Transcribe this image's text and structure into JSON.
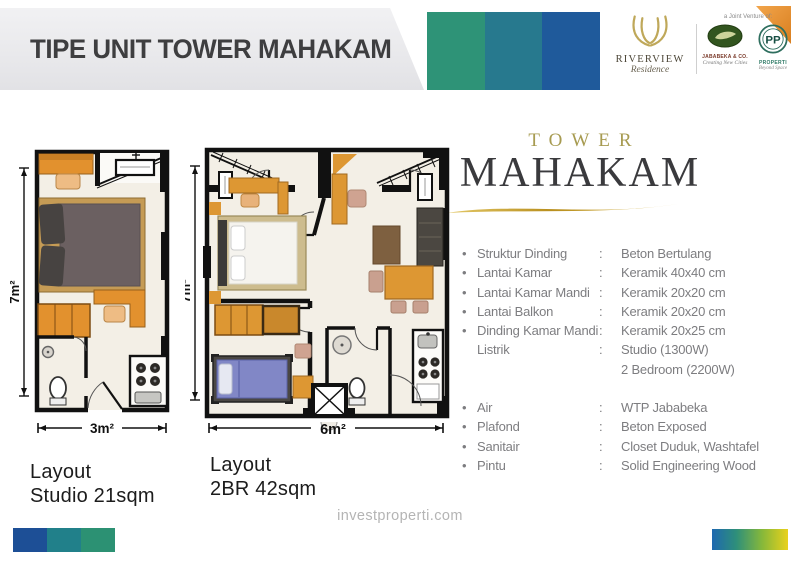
{
  "header": {
    "title": "TIPE UNIT TOWER MAHAKAM",
    "logos": {
      "riverview": {
        "name": "RIVERVIEW",
        "sub": "Residence"
      },
      "joint_venture_label": "a Joint Venture of:",
      "jababeka": {
        "name": "JABABEKA & CO.",
        "tagline": "Creating New Cities"
      },
      "pp": {
        "monogram": "PP",
        "name": "PROPERTI",
        "tagline": "Beyond Space"
      }
    }
  },
  "tower": {
    "pre": "TOWER",
    "name": "MAHAKAM"
  },
  "specs": {
    "items": [
      {
        "bullet": "•",
        "label": "Struktur Dinding",
        "colon": ":",
        "value": "Beton Bertulang"
      },
      {
        "bullet": "•",
        "label": "Lantai Kamar",
        "colon": ":",
        "value": "Keramik 40x40 cm"
      },
      {
        "bullet": "•",
        "label": "Lantai Kamar Mandi",
        "colon": ":",
        "value": "Keramik 20x20 cm"
      },
      {
        "bullet": "•",
        "label": "Lantai Balkon",
        "colon": ":",
        "value": "Keramik 20x20 cm"
      },
      {
        "bullet": "•",
        "label": "Dinding Kamar Mandi",
        "colon": ":",
        "value": "Keramik 20x25 cm"
      },
      {
        "bullet": "",
        "label": "Listrik",
        "colon": ":",
        "value": "Studio (1300W)"
      },
      {
        "bullet": "",
        "label": "",
        "colon": "",
        "value": "2 Bedroom (2200W)",
        "gap_after": true
      },
      {
        "bullet": "•",
        "label": "Air",
        "colon": ":",
        "value": "WTP Jababeka"
      },
      {
        "bullet": "•",
        "label": "Plafond",
        "colon": ":",
        "value": "Beton Exposed"
      },
      {
        "bullet": "•",
        "label": "Sanitair",
        "colon": ":",
        "value": "Closet Duduk, Washtafel"
      },
      {
        "bullet": "•",
        "label": "Pintu",
        "colon": ":",
        "value": "Solid Engineering Wood"
      }
    ]
  },
  "plans": {
    "studio": {
      "side_dim": "7m²",
      "bottom_dim": "3m²",
      "caption_line1": "Layout",
      "caption_line2": "Studio 21sqm"
    },
    "two_br": {
      "side_dim": "7m²",
      "bottom_dim": "6m²",
      "caption_line1": "Layout",
      "caption_line2": "2BR 42sqm"
    }
  },
  "footer": {
    "website": "investproperti.com"
  },
  "colors": {
    "bar_green": "#2e9377",
    "bar_teal": "#27798e",
    "bar_blue": "#1f5a9b",
    "gold": "#a79b51",
    "swoosh_gold": "#c9a227",
    "corner_orange": "#e28a2f",
    "furniture_orange": "#dd9733",
    "bed2_blue": "#8187c6",
    "grad_blue": "#1e68b0",
    "grad_green": "#86b83a",
    "grad_yellow": "#e9d11b"
  }
}
